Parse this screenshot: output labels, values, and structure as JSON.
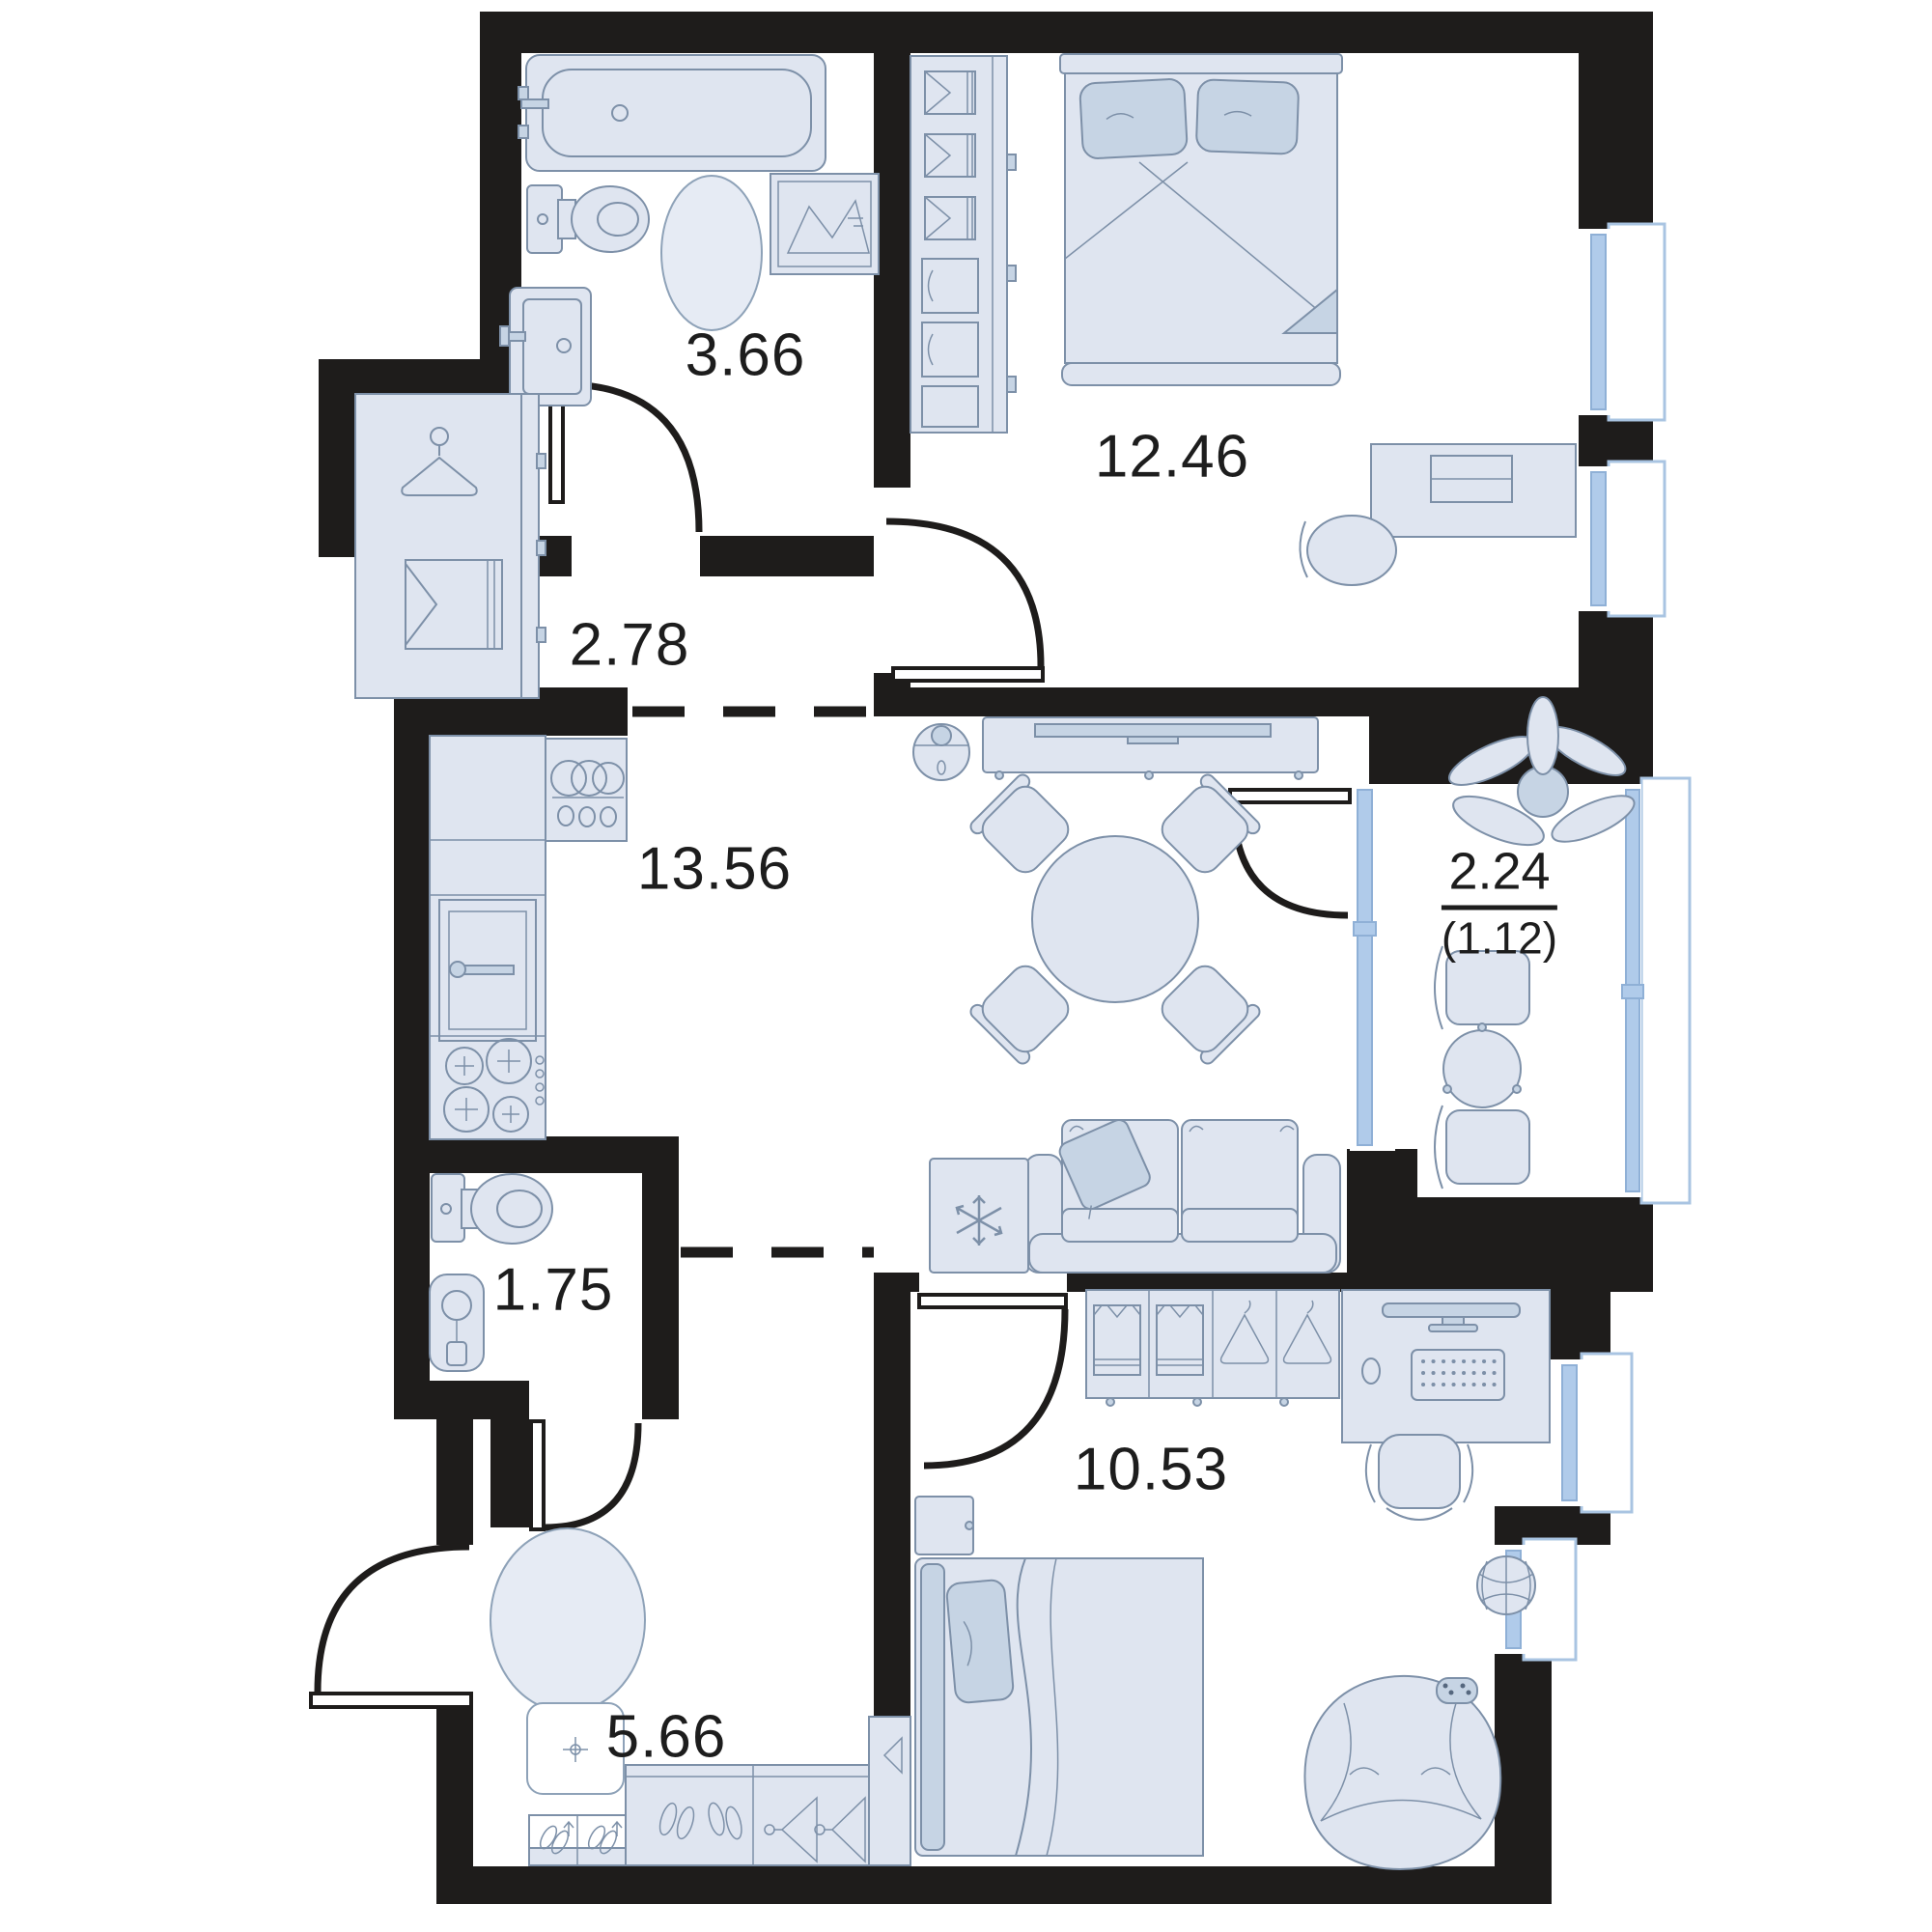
{
  "plan": {
    "type": "apartment-floor-plan",
    "rooms": [
      {
        "id": "bathroom",
        "area": "3.66"
      },
      {
        "id": "hallway-top",
        "area": "2.78"
      },
      {
        "id": "bedroom-main",
        "area": "12.46"
      },
      {
        "id": "kitchen-living",
        "area": "13.56"
      },
      {
        "id": "balcony",
        "area": "2.24",
        "area_secondary": "(1.12)"
      },
      {
        "id": "wc",
        "area": "1.75"
      },
      {
        "id": "hallway-entry",
        "area": "5.66"
      },
      {
        "id": "bedroom-second",
        "area": "10.53"
      }
    ],
    "colors": {
      "wall": "#1e1c1b",
      "furniture_fill": "#dfe5f0",
      "furniture_accent": "#c6d4e4",
      "furniture_stroke": "#7d90a8",
      "window_glass": "#b0cbea",
      "window_frame": "#a9c4e2",
      "text": "#1d1d1d",
      "background": "#ffffff"
    },
    "furniture_icons": [
      "bathtub-icon",
      "toilet-icon",
      "sink-icon",
      "rug-icon",
      "laundry-basket-icon",
      "hanger-icon",
      "wardrobe-icon",
      "washing-machine-icon",
      "oven-icon",
      "stove-icon",
      "water-heater-icon",
      "doormat-icon",
      "shoe-rack-icon",
      "double-bed-icon",
      "desk-icon",
      "tv-console-icon",
      "robot-vacuum-icon",
      "dining-table-icon",
      "chair-icon",
      "sofa-icon",
      "fridge-icon",
      "plant-icon",
      "balcony-table-icon",
      "single-bed-icon",
      "monitor-icon",
      "keyboard-icon",
      "office-chair-icon",
      "nightstand-icon",
      "bean-bag-icon",
      "basketball-icon",
      "gamepad-icon"
    ]
  }
}
